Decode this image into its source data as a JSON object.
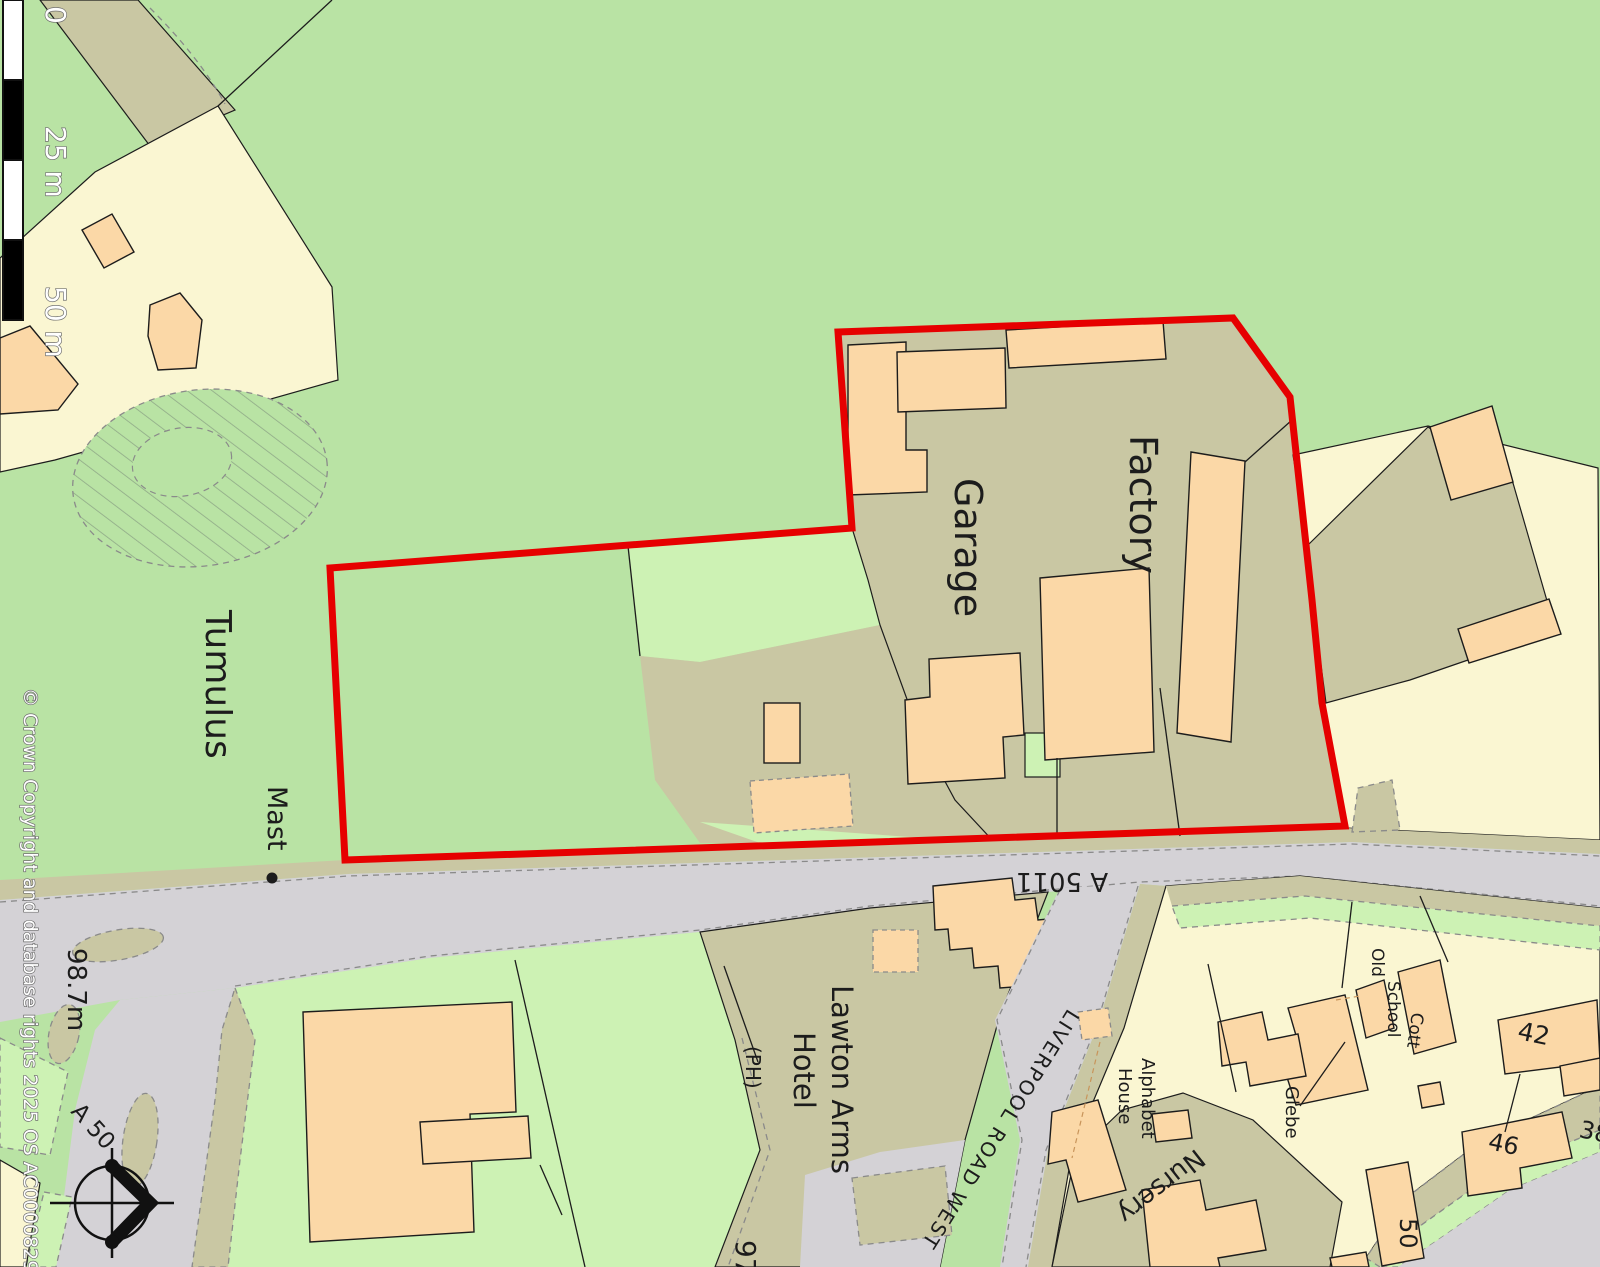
{
  "map": {
    "type": "ordnance-survey-site-plan",
    "colors": {
      "field_green": "#b9e3a4",
      "parcel_green": "#cdf2b4",
      "developed_khaki": "#c9c7a3",
      "building_peach": "#fbd8a7",
      "garden_yellow": "#faf6d2",
      "road_grey": "#d4d2d6",
      "site_boundary_red": "#e60000",
      "outline": "#1c1c1c"
    },
    "scale_bar": {
      "tick0": "0",
      "tick25": "25 m",
      "tick50": "50 m"
    },
    "copyright": "© Crown Copyright and database rights 2025 OS AC0000829429",
    "labels": {
      "tumulus": "Tumulus",
      "mast": "Mast",
      "garage": "Garage",
      "factory": "Factory",
      "lawton_arms": "Lawton Arms",
      "hotel": "Hotel",
      "ph": "(PH)",
      "spot_height_a": "98.7m",
      "spot_height_b": "97",
      "a50": "A 50",
      "a5011": "A 5011",
      "liverpool_road_west": "LIVERPOOL ROAD WEST",
      "old": "Old",
      "school": "School",
      "cott": "Cott",
      "glebe": "Glebe",
      "alphabet": "Alphabet",
      "house": "House",
      "nursery": "Nursery",
      "no38": "38",
      "no42": "42",
      "no46": "46",
      "no50": "50"
    }
  }
}
